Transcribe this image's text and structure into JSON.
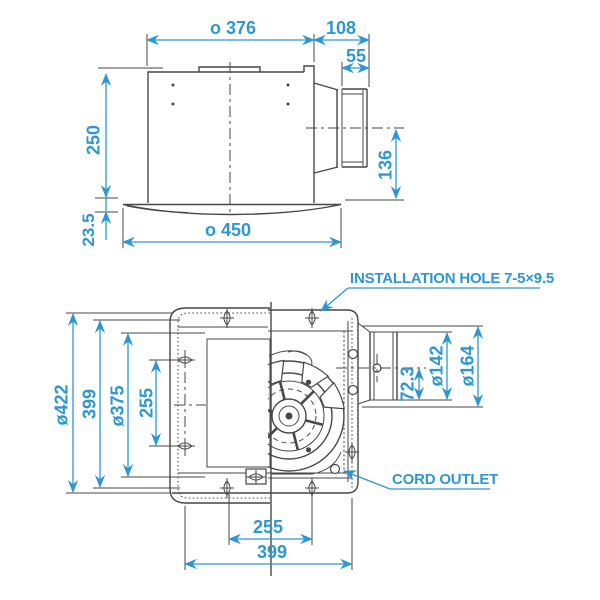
{
  "colors": {
    "line": "#474747",
    "dimension": "#2d97d3",
    "background": "#ffffff"
  },
  "top_view": {
    "dim_body_width": "o 376",
    "dim_duct_depth": "108",
    "dim_duct_length": "55",
    "dim_body_height": "250",
    "dim_flange_height": "23.5",
    "dim_flange_width": "o 450",
    "dim_duct_center_height": "136"
  },
  "bottom_view": {
    "label_installation_hole": "INSTALLATION HOLE 7-5×9.5",
    "label_cord_outlet": "CORD OUTLET",
    "dim_overall_height": "ø422",
    "dim_hole_span_vertical": "399",
    "dim_opening_dia": "ø375",
    "dim_side_hole_span": "255",
    "dim_duct_offset": "72.3",
    "dim_duct_inner_dia": "ø142",
    "dim_duct_outer_dia": "ø164",
    "dim_hole_span_horizontal": "255",
    "dim_frame_width": "399"
  }
}
